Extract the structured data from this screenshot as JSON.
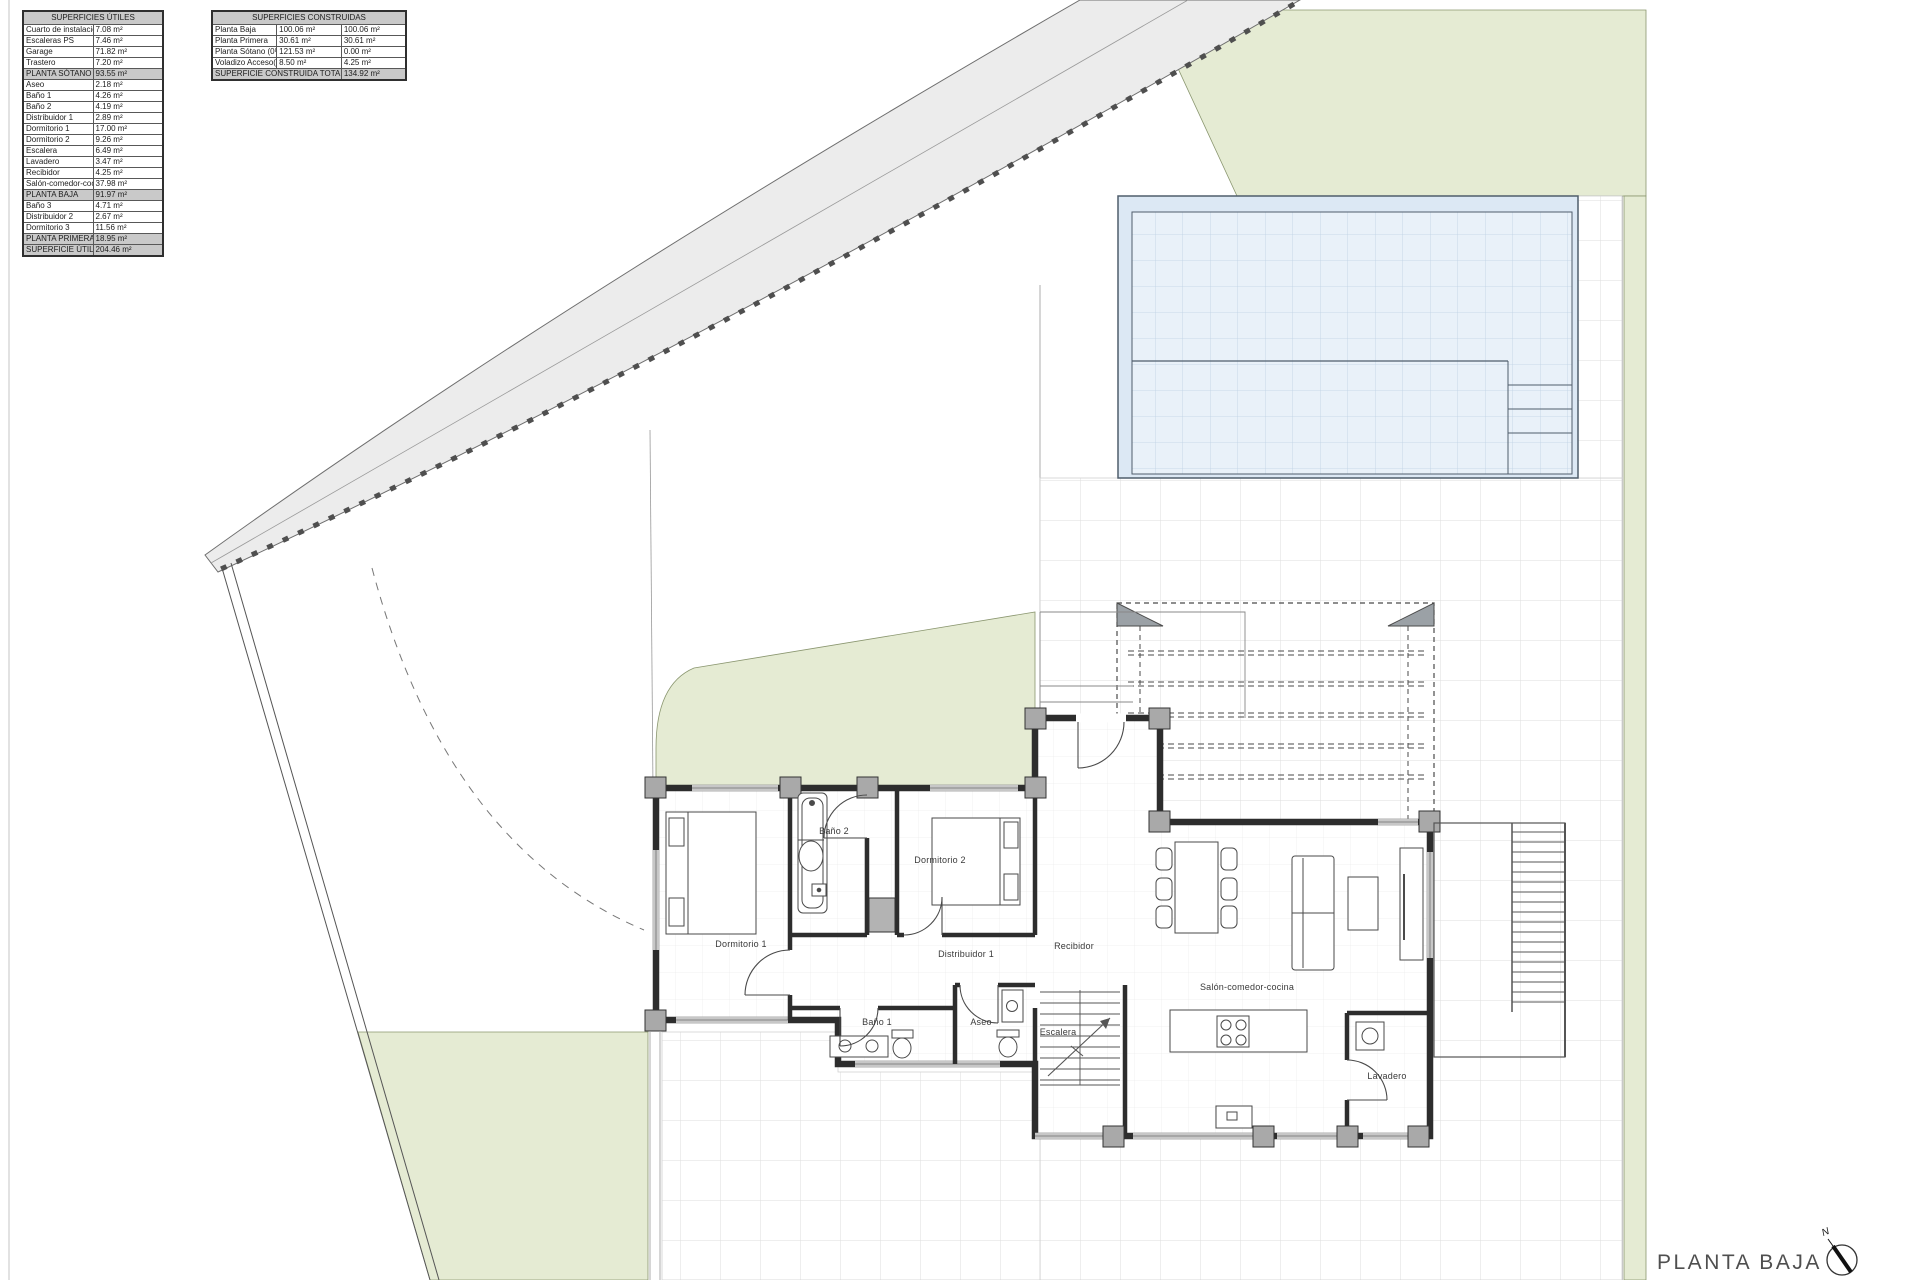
{
  "tables": {
    "utiles": {
      "title": "SUPERFICIES ÚTILES",
      "rows": [
        {
          "label": "Cuarto de instalaciones",
          "value": "7.08 m²",
          "variant": "normal"
        },
        {
          "label": "Escaleras PS",
          "value": "7.46 m²",
          "variant": "normal"
        },
        {
          "label": "Garage",
          "value": "71.82 m²",
          "variant": "normal"
        },
        {
          "label": "Trastero",
          "value": "7.20 m²",
          "variant": "normal"
        },
        {
          "label": "PLANTA SÓTANO",
          "value": "93.55 m²",
          "variant": "section"
        },
        {
          "label": "Aseo",
          "value": "2.18 m²",
          "variant": "normal"
        },
        {
          "label": "Baño 1",
          "value": "4.26 m²",
          "variant": "normal"
        },
        {
          "label": "Baño 2",
          "value": "4.19 m²",
          "variant": "normal"
        },
        {
          "label": "Distribuidor 1",
          "value": "2.89 m²",
          "variant": "normal"
        },
        {
          "label": "Dormitorio 1",
          "value": "17.00 m²",
          "variant": "normal"
        },
        {
          "label": "Dormitorio 2",
          "value": "9.26 m²",
          "variant": "normal"
        },
        {
          "label": "Escalera",
          "value": "6.49 m²",
          "variant": "normal"
        },
        {
          "label": "Lavadero",
          "value": "3.47 m²",
          "variant": "normal"
        },
        {
          "label": "Recibidor",
          "value": "4.25 m²",
          "variant": "normal"
        },
        {
          "label": "Salón-comedor-cocina",
          "value": "37.98 m²",
          "variant": "normal"
        },
        {
          "label": "PLANTA BAJA",
          "value": "91.97 m²",
          "variant": "section"
        },
        {
          "label": "Baño 3",
          "value": "4.71 m²",
          "variant": "normal"
        },
        {
          "label": "Distribuidor 2",
          "value": "2.67 m²",
          "variant": "normal"
        },
        {
          "label": "Dormitorio 3",
          "value": "11.56 m²",
          "variant": "normal"
        },
        {
          "label": "PLANTA PRIMERA",
          "value": "18.95 m²",
          "variant": "section"
        },
        {
          "label": "SUPERFICIE ÚTIL TOTAL",
          "value": "204.46 m²",
          "variant": "total"
        }
      ]
    },
    "construidas": {
      "title": "SUPERFICIES CONSTRUIDAS",
      "rows": [
        {
          "label": "Planta Baja",
          "v1": "100.06 m²",
          "v2": "100.06 m²"
        },
        {
          "label": "Planta Primera",
          "v1": "30.61 m²",
          "v2": "30.61 m²"
        },
        {
          "label": "Planta Sótano (0%)",
          "v1": "121.53 m²",
          "v2": "0.00 m²"
        },
        {
          "label": "Voladizo Acceso(50%)",
          "v1": "8.50 m²",
          "v2": "4.25 m²"
        }
      ],
      "total": {
        "label": "SUPERFICIE CONSTRUIDA TOTAL",
        "value": "134.92 m²"
      }
    }
  },
  "plan": {
    "title": "PLANTA BAJA",
    "north_label": "N",
    "rooms": {
      "dormitorio1": "Dormitorio 1",
      "bano2": "Baño 2",
      "dormitorio2": "Dormitorio 2",
      "distribuidor1": "Distribuidor 1",
      "recibidor": "Recibidor",
      "bano1": "Baño 1",
      "aseo": "Aseo",
      "escalera": "Escalera",
      "salon": "Salón-comedor-cocina",
      "lavadero": "Lavadero"
    },
    "colors": {
      "garden_green": "#e5ebd3",
      "pool_blue": "#e9f1f9",
      "road_grey": "#ececec",
      "wall_dark": "#2d2d2d"
    }
  }
}
